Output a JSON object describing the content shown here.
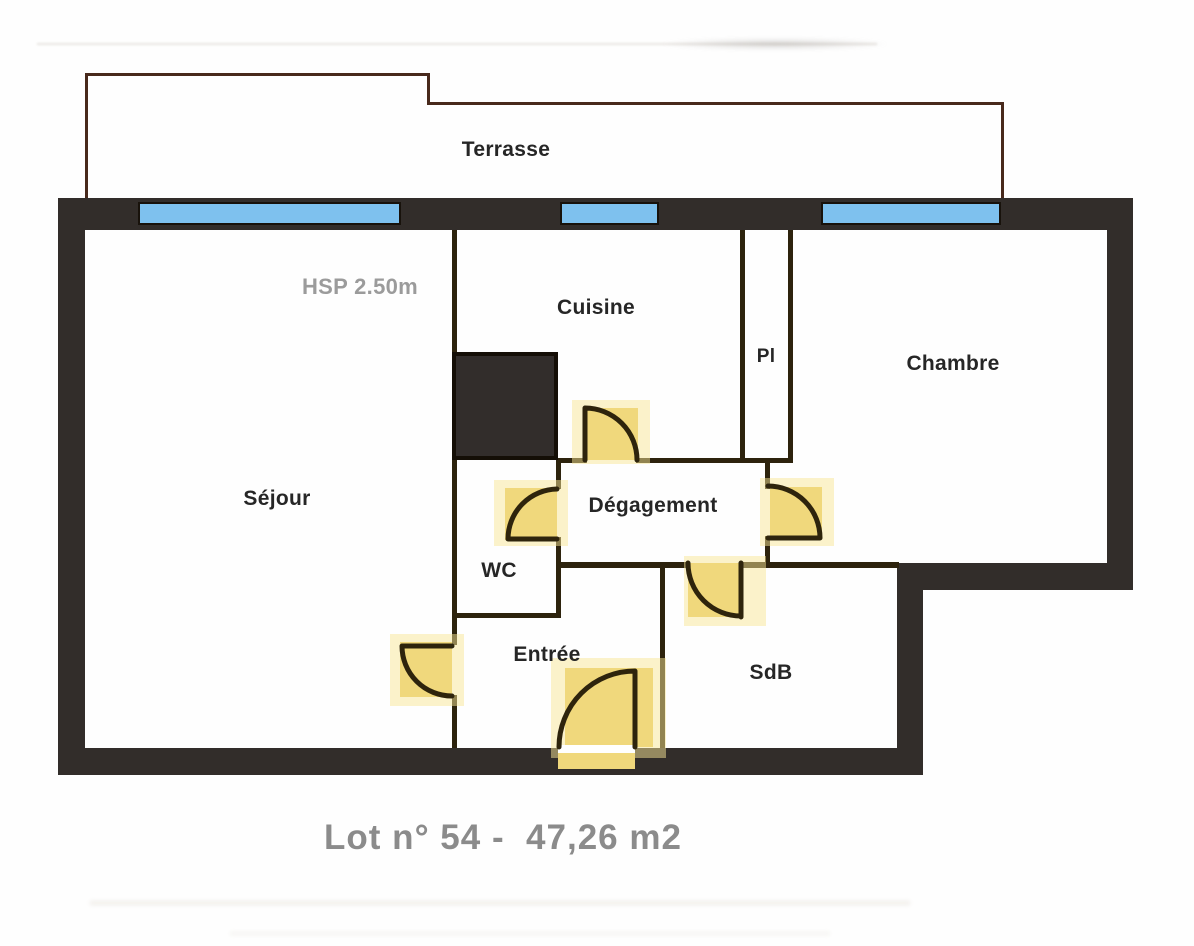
{
  "labels": {
    "terrasse": "Terrasse",
    "hsp": "HSP 2.50m",
    "cuisine": "Cuisine",
    "pl": "Pl",
    "chambre": "Chambre",
    "sejour": "Séjour",
    "degagement": "Dégagement",
    "wc": "WC",
    "entree": "Entrée",
    "sdb": "SdB"
  },
  "caption": "Lot n° 54 -  47,26 m2",
  "colors": {
    "wall": "#322d2a",
    "thin_wall": "#2d230d",
    "window_blue": "#7ec1ee",
    "door_yellow": "#f0d87c",
    "terrace_outline": "#48291c",
    "label_dark": "#262626",
    "label_gray": "#9b9b9b",
    "caption_gray": "#8b8b8b"
  }
}
